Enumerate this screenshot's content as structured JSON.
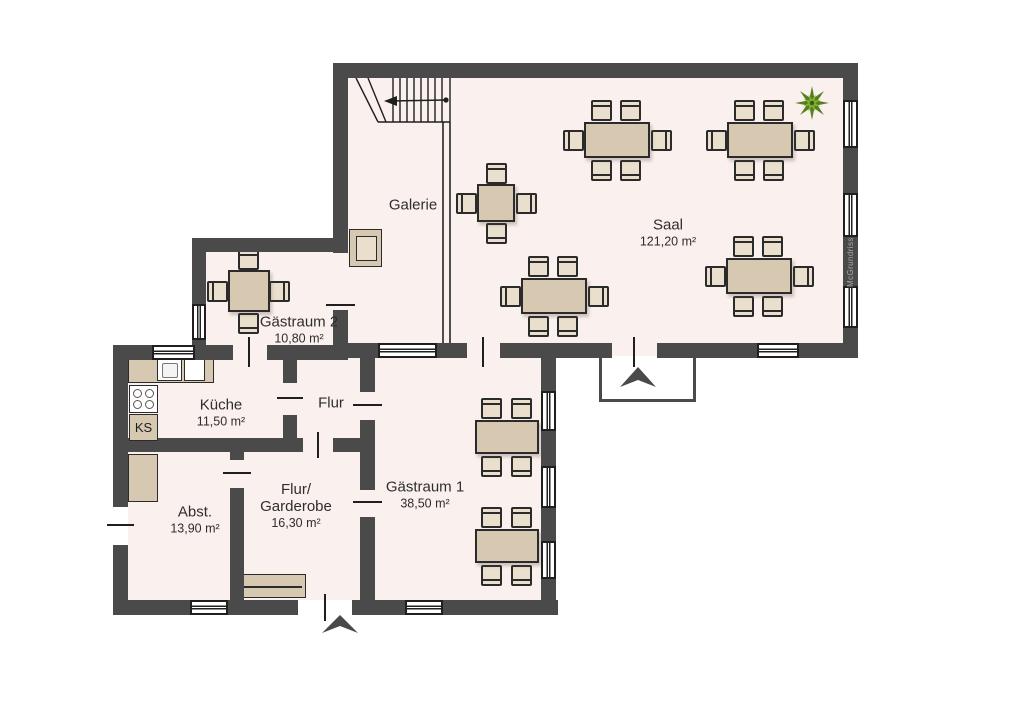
{
  "watermark": "McGrundriss",
  "rooms": {
    "galerie": {
      "name": "Galerie"
    },
    "saal": {
      "name": "Saal",
      "area": "121,20 m²"
    },
    "gaestraum2": {
      "name": "Gästraum 2",
      "area": "10,80 m²"
    },
    "kueche": {
      "name": "Küche",
      "area": "11,50 m²"
    },
    "flur": {
      "name": "Flur"
    },
    "abstellraum": {
      "name": "Abst.",
      "area": "13,90 m²"
    },
    "flur_garderobe": {
      "name_line1": "Flur/",
      "name_line2": "Garderobe",
      "area": "16,30 m²"
    },
    "gaestraum1": {
      "name": "Gästraum 1",
      "area": "38,50 m²"
    }
  },
  "kitchen": {
    "fridge_label": "KS"
  },
  "icons": {
    "plant": "star-shaped-plant",
    "entrance_arrows": "up-pointing-entrance-arrow",
    "stairs": "staircase-with-walk-line-arrow"
  },
  "colors": {
    "wall": "#4a4a4a",
    "floor": "#faf0ed",
    "furniture": "#d6c8b1",
    "chair": "#e9dfcc",
    "plant_dark": "#55801f",
    "plant_light": "#87b335",
    "text": "#2e2e2e",
    "watermark_text": "#a9a9a9"
  }
}
